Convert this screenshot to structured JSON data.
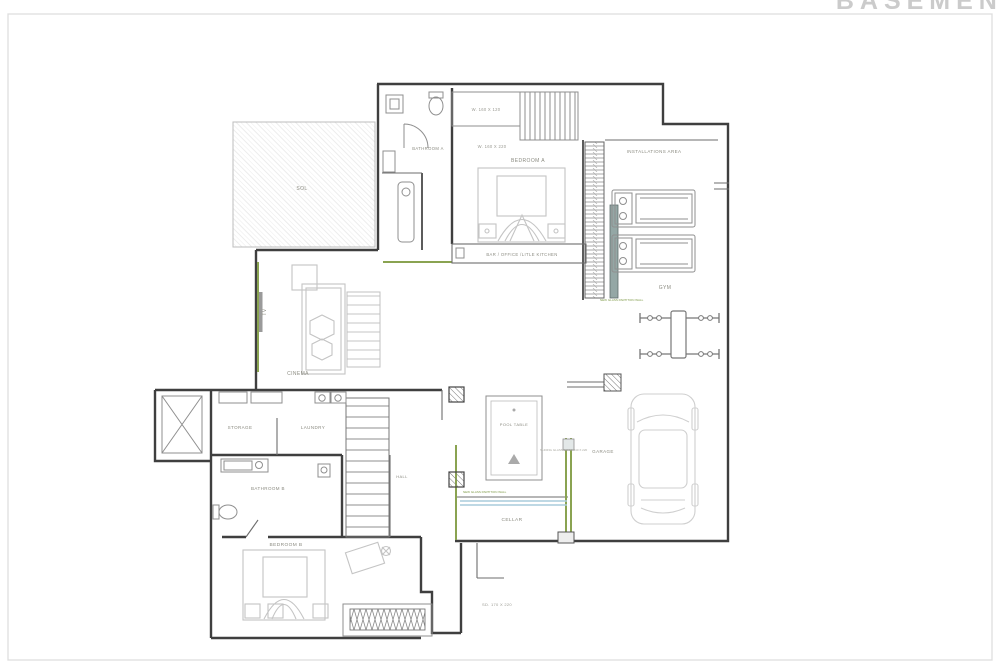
{
  "title": "BASEMENT",
  "rooms": {
    "sol": "SOL",
    "bathroom_a": "BATHROOM A",
    "bedroom_a": "BEDROOM A",
    "installations_area": "INSTALLATIONS AREA",
    "gym": "GYM",
    "bar_office": "BAR / OFFICE /LITLE KITCHEN",
    "tv": "TV",
    "cinema": "CINEMA",
    "storage": "STORAGE",
    "laundry": "LAUNDRY",
    "bathroom_b": "BATHROOM B",
    "hall": "HALL",
    "bedroom_b": "BEDROOM B",
    "pool_table": "POOL TABLE",
    "garage": "GARAGE",
    "cellar": "CELLAR"
  },
  "dimensions": {
    "wardrobe_a1": "W. 160 X 120",
    "wardrobe_a2": "W. 160 X 220",
    "sliding_door": "SD. 170 X 220"
  },
  "notes": {
    "glass_wall_cellar": "NEW GLASS PARTITION WALL",
    "glass_wall_gym": "NEW GLASS PARTITION WALL",
    "sliding_glass_door": "SLIDING GLASS DOOR 240 X 220"
  },
  "colors": {
    "wall": "#3f3f3f",
    "accent_green": "#8aa351",
    "accent_blue": "#a9cbdc",
    "partition_gray": "#94a7a5",
    "furniture": "#c4c4c4",
    "label": "#8b8b81",
    "title": "#cbcbcb",
    "frame": "#dedede"
  }
}
